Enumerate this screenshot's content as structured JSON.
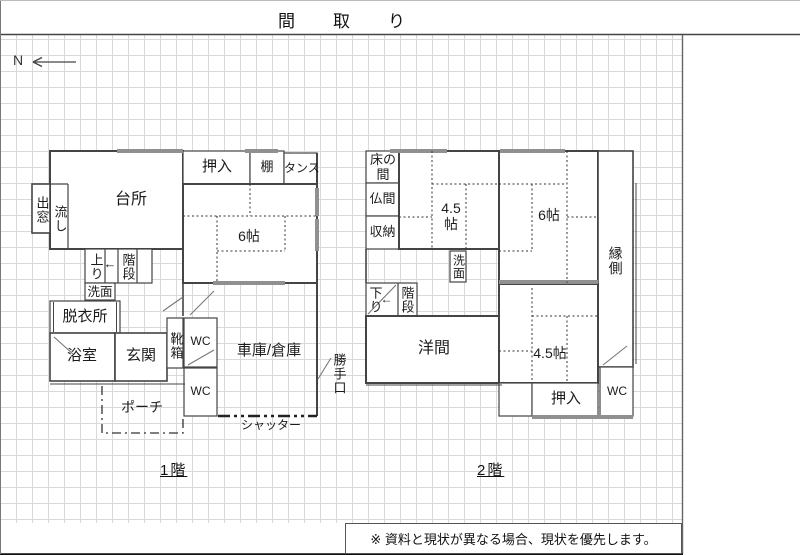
{
  "title": "間取り",
  "compass": {
    "label": "N"
  },
  "floor1": {
    "label": "1階",
    "rooms": {
      "kitchen": "台所",
      "bay_window": "出窓",
      "sink": "流し",
      "closet": "押入",
      "shelf": "棚",
      "dresser": "タンス",
      "tatami_6": "6帖",
      "step_up": "上り",
      "stairs": "階段",
      "stairs_arrow": "←",
      "washbasin": "洗面",
      "dressing_room": "脱衣所",
      "bathroom": "浴室",
      "entrance": "玄関",
      "shoe_box": "靴箱",
      "wc_upper": "WC",
      "wc_lower": "WC",
      "garage": "車庫/倉庫",
      "back_door": "勝手口",
      "shutter": "シャッター",
      "porch": "ポーチ"
    }
  },
  "floor2": {
    "label": "2階",
    "rooms": {
      "tokonoma": "床の間",
      "butsuma": "仏間",
      "storage": "収納",
      "tatami_45_upper": "4.5帖",
      "tatami_6": "6帖",
      "engawa": "縁側",
      "washbasin": "洗面",
      "step_down": "下り",
      "stairs": "階段",
      "stairs_arrow": "←",
      "western_room": "洋間",
      "tatami_45_lower": "4.5帖",
      "closet": "押入",
      "wc": "WC"
    }
  },
  "note": "※ 資料と現状が異なる場合、現状を優先します。"
}
